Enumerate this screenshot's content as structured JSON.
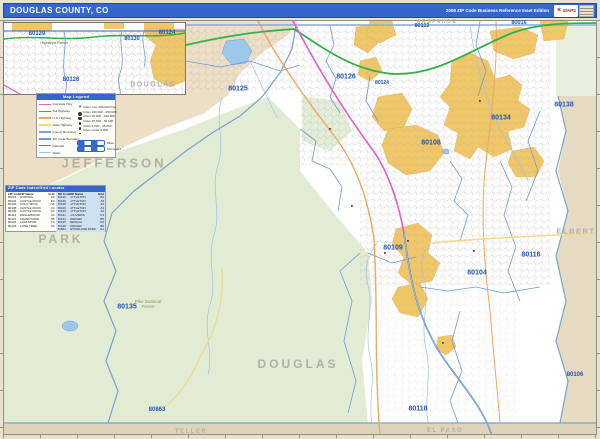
{
  "title_bar": {
    "title": "DOUGLAS COUNTY, CO",
    "edition": "2008 ZIP Code Business Reference Inset Edition",
    "logo_text": "MAPS"
  },
  "inset": {
    "labels": [
      {
        "text": "80129",
        "x": 36,
        "y": 33,
        "type": "zip",
        "size": 6
      },
      {
        "text": "Highlands Ranch",
        "x": 53,
        "y": 42,
        "type": "place",
        "size": 3.6
      },
      {
        "text": "80130",
        "x": 131,
        "y": 38,
        "type": "zip",
        "size": 5.5
      },
      {
        "text": "80124",
        "x": 166,
        "y": 32,
        "type": "zip",
        "size": 6
      },
      {
        "text": "80126",
        "x": 70,
        "y": 79,
        "type": "zip",
        "size": 6
      },
      {
        "text": "DOUGLAS",
        "x": 152,
        "y": 84,
        "type": "county",
        "size": 7
      }
    ]
  },
  "legend": {
    "title": "Map Legend",
    "line_items": [
      {
        "label": "Interstate Hwy.",
        "color": "#e25fc8"
      },
      {
        "label": "Toll Highway",
        "color": "#2eb34a"
      },
      {
        "label": "U.S. Highway",
        "color": "#f0a860"
      },
      {
        "label": "State Highway",
        "color": "#f2d98a"
      },
      {
        "label": "County Boundary",
        "color": "#7aa2cc"
      },
      {
        "label": "ZIP Code Boundary",
        "color": "#6f9bd6"
      },
      {
        "label": "Railroad",
        "color": "#777777"
      },
      {
        "label": "Water",
        "color": "#9ec8ea"
      }
    ],
    "city_items": [
      "Cities over 250,000 Pop.",
      "Cities 100,000 - 250,000",
      "Cities 50,000 - 100,000",
      "Cities 25,000 - 50,000",
      "Cities 5,000 - 25,000",
      "Cities under 5,000"
    ],
    "scale_items": [
      "Miles",
      "Kilometers"
    ]
  },
  "zip_table": {
    "title": "ZIP Code Index/Grid Locator",
    "columns": [
      "ZIP Code",
      "ZIP Name",
      "Grid"
    ],
    "left_rows": [
      [
        "80016",
        "AURORA",
        "A6"
      ],
      [
        "80104",
        "CASTLE ROCK",
        "E4"
      ],
      [
        "80106",
        "COLO SPGS",
        "G5"
      ],
      [
        "80108",
        "CASTLE ROCK",
        "C4"
      ],
      [
        "80109",
        "CASTLE ROCK",
        "D3"
      ],
      [
        "80112",
        "ENGLEWOOD",
        "A4"
      ],
      [
        "80116",
        "FRANKTOWN",
        "D5"
      ],
      [
        "80118",
        "LARKSPUR",
        "F4"
      ],
      [
        "80124",
        "LONE TREE",
        "A4"
      ]
    ],
    "right_rows": [
      [
        "80125",
        "LITTLETON",
        "B2"
      ],
      [
        "80126",
        "LITTLETON",
        "A3"
      ],
      [
        "80128",
        "LITTLETON",
        "A2"
      ],
      [
        "80129",
        "LITTLETON",
        "A3"
      ],
      [
        "80130",
        "LITTLETON",
        "A4"
      ],
      [
        "80131",
        "LOUVIERS",
        "C3"
      ],
      [
        "80134",
        "PARKER",
        "B5"
      ],
      [
        "80135",
        "SEDALIA",
        "D2"
      ],
      [
        "80138",
        "PARKER",
        "B6"
      ],
      [
        "80863",
        "WOODLAND PARK",
        "G1"
      ]
    ]
  },
  "map": {
    "zip_labels": [
      {
        "text": "80125",
        "x": 237,
        "y": 88,
        "size": 7
      },
      {
        "text": "80126",
        "x": 345,
        "y": 76,
        "size": 7
      },
      {
        "text": "80112",
        "x": 421,
        "y": 25,
        "size": 5.5
      },
      {
        "text": "80016",
        "x": 518,
        "y": 22,
        "size": 5.5
      },
      {
        "text": "80124",
        "x": 381,
        "y": 82,
        "size": 5
      },
      {
        "text": "80138",
        "x": 563,
        "y": 104,
        "size": 7
      },
      {
        "text": "80134",
        "x": 500,
        "y": 117,
        "size": 7
      },
      {
        "text": "80108",
        "x": 430,
        "y": 142,
        "size": 7
      },
      {
        "text": "80109",
        "x": 392,
        "y": 247,
        "size": 7
      },
      {
        "text": "80104",
        "x": 476,
        "y": 272,
        "size": 7
      },
      {
        "text": "80116",
        "x": 530,
        "y": 254,
        "size": 7
      },
      {
        "text": "80118",
        "x": 417,
        "y": 408,
        "size": 7
      },
      {
        "text": "80135",
        "x": 126,
        "y": 306,
        "size": 7
      },
      {
        "text": "80863",
        "x": 156,
        "y": 409,
        "size": 6
      },
      {
        "text": "80106",
        "x": 574,
        "y": 374,
        "size": 6
      }
    ],
    "county_labels": [
      {
        "text": "ARAPAHOE",
        "x": 436,
        "y": 21,
        "size": 5,
        "ls": 1.5
      },
      {
        "text": "JEFFERSON",
        "x": 113,
        "y": 162,
        "size": 13,
        "ls": 3
      },
      {
        "text": "PARK",
        "x": 60,
        "y": 238,
        "size": 12,
        "ls": 3
      },
      {
        "text": "DOUGLAS",
        "x": 297,
        "y": 363,
        "size": 12,
        "ls": 3
      },
      {
        "text": "ELBERT",
        "x": 575,
        "y": 230,
        "size": 7.5,
        "ls": 1.5
      },
      {
        "text": "TELLER",
        "x": 190,
        "y": 431,
        "size": 6,
        "ls": 1.5
      },
      {
        "text": "EL PASO",
        "x": 444,
        "y": 430,
        "size": 6,
        "ls": 1.5
      }
    ],
    "place_labels": [
      {
        "text": "Pike National Forest",
        "x": 147,
        "y": 304
      }
    ]
  }
}
